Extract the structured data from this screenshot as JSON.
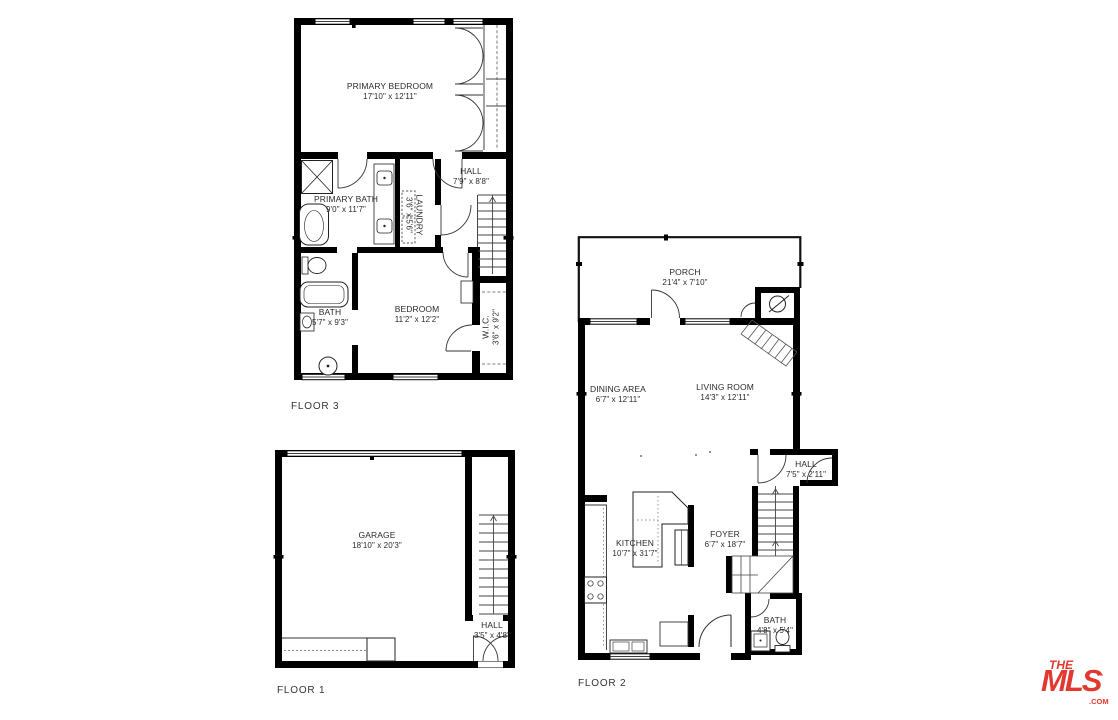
{
  "colors": {
    "walls": "#000000",
    "thin_lines": "#4a4a4a",
    "text": "#2b2b2b",
    "logo_red": "#e1392f",
    "background": "#ffffff"
  },
  "floor3": {
    "label": "FLOOR 3",
    "rooms": [
      {
        "id": "primary-bedroom",
        "name": "PRIMARY BEDROOM",
        "dims": "17'10\" x 12'11\""
      },
      {
        "id": "hall",
        "name": "HALL",
        "dims": "7'9\" x 8'8\""
      },
      {
        "id": "primary-bath",
        "name": "PRIMARY BATH",
        "dims": "9'0\" x 11'7\""
      },
      {
        "id": "laundry",
        "name": "LAUNDRY",
        "dims": "3'6\" x 5'6\""
      },
      {
        "id": "bedroom",
        "name": "BEDROOM",
        "dims": "11'2\" x 12'2\""
      },
      {
        "id": "bath",
        "name": "BATH",
        "dims": "5'7\" x 9'3\""
      },
      {
        "id": "wic",
        "name": "W.I.C.",
        "dims": "3'6\" x 9'2\""
      }
    ]
  },
  "floor1": {
    "label": "FLOOR 1",
    "rooms": [
      {
        "id": "garage",
        "name": "GARAGE",
        "dims": "18'10\" x 20'3\""
      },
      {
        "id": "hall",
        "name": "HALL",
        "dims": "3'5\" x 4'8\""
      }
    ]
  },
  "floor2": {
    "label": "FLOOR 2",
    "rooms": [
      {
        "id": "porch",
        "name": "PORCH",
        "dims": "21'4\" x 7'10\""
      },
      {
        "id": "dining-area",
        "name": "DINING AREA",
        "dims": "6'7\" x 12'11\""
      },
      {
        "id": "living-room",
        "name": "LIVING ROOM",
        "dims": "14'3\" x 12'11\""
      },
      {
        "id": "hall",
        "name": "HALL",
        "dims": "7'5\" x 2'11\""
      },
      {
        "id": "kitchen",
        "name": "KITCHEN",
        "dims": "10'7\" x 31'7\""
      },
      {
        "id": "foyer",
        "name": "FOYER",
        "dims": "6'7\" x 18'7\""
      },
      {
        "id": "bath",
        "name": "BATH",
        "dims": "4'8\" x 5'4\""
      }
    ]
  },
  "logo": {
    "the": "THE",
    "mls": "MLS",
    "tm": "™",
    "com": ".COM"
  }
}
